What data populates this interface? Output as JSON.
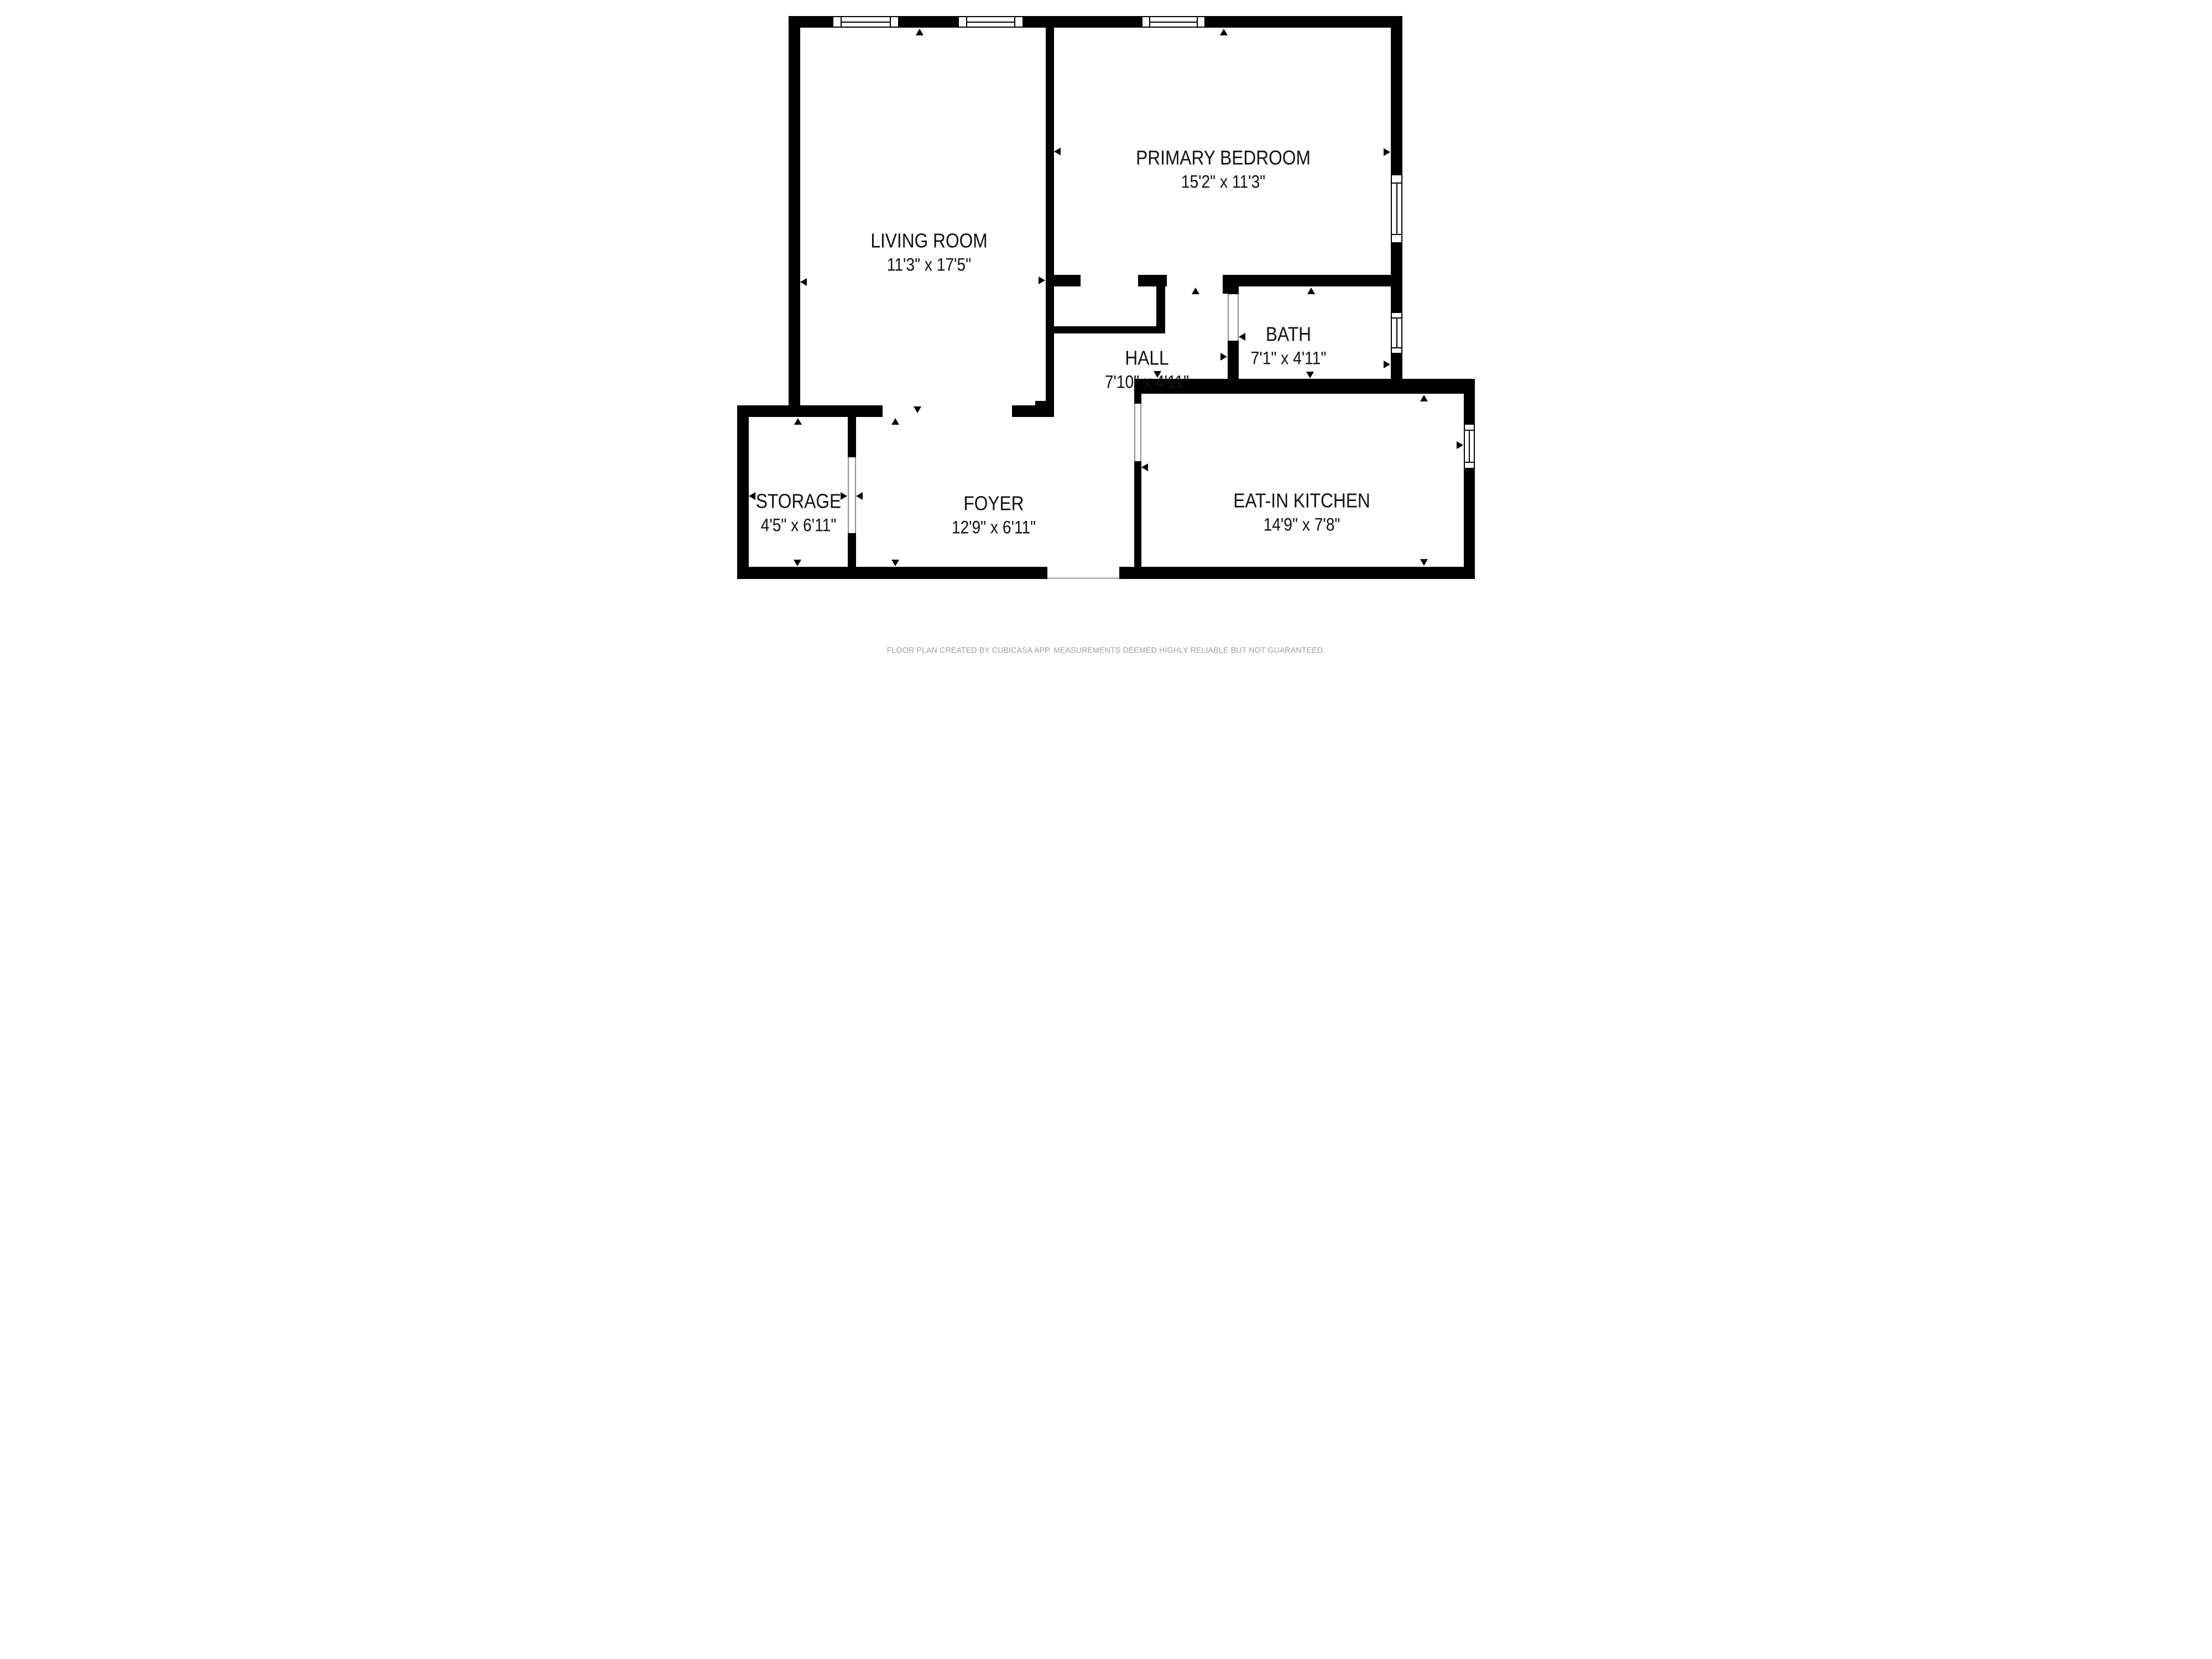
{
  "plan": {
    "type": "floor-plan",
    "creator_note": "FLOOR PLAN CREATED BY CUBICASA APP. MEASUREMENTS DEEMED HIGHLY RELIABLE BUT NOT GUARANTEED.",
    "colors": {
      "wall": "#000000",
      "background": "#ffffff",
      "label_text": "#111111",
      "footer_text": "#9e9e9e",
      "door_jamb": "#8f8f8f"
    },
    "rooms": {
      "living_room": {
        "name": "LIVING ROOM",
        "dims": "11'3\" x 17'5\""
      },
      "primary_bedroom": {
        "name": "PRIMARY BEDROOM",
        "dims": "15'2\" x 11'3\""
      },
      "bath": {
        "name": "BATH",
        "dims": "7'1\" x 4'11\""
      },
      "hall": {
        "name": "HALL",
        "dims": "7'10\" x 4'11\""
      },
      "storage": {
        "name": "STORAGE",
        "dims": "4'5\" x 6'11\""
      },
      "foyer": {
        "name": "FOYER",
        "dims": "12'9\" x 6'11\""
      },
      "eat_in_kitchen": {
        "name": "EAT-IN KITCHEN",
        "dims": "14'9\" x 7'8\""
      }
    },
    "window_count": 6,
    "door_arrow_count": 24
  }
}
